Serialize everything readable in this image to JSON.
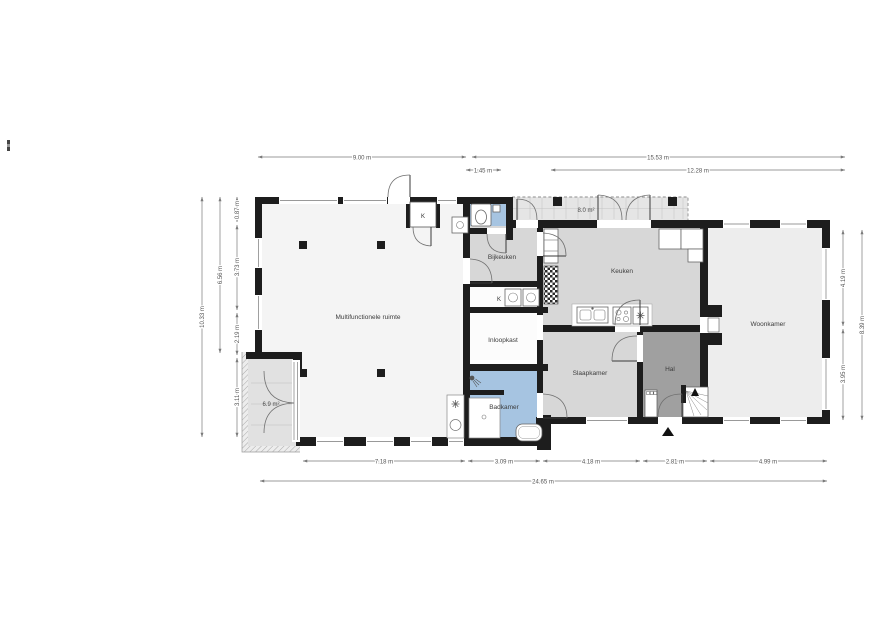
{
  "plan": {
    "rooms": {
      "multifunctionele_ruimte": "Multifunctionele ruimte",
      "bijkeuken": "Bijkeuken",
      "keuken": "Keuken",
      "woonkamer": "Woonkamer",
      "inloopkast": "Inloopkast",
      "slaapkamer": "Slaapkamer",
      "hal": "Hal",
      "badkamer": "Badkamer"
    },
    "areas": {
      "terrace": "8.0 m²",
      "porch": "6.9 m²"
    },
    "closets": {
      "top": "K",
      "laundry": "K"
    },
    "dims": {
      "top_9": "9.00 m",
      "top_145": "1.45 m",
      "top_1553": "15.53 m",
      "top_1228": "12.28 m",
      "bottom_718": "7.18 m",
      "bottom_309": "3.09 m",
      "bottom_418": "4.18 m",
      "bottom_281": "2.81 m",
      "bottom_499": "4.99 m",
      "bottom_total": "24.65 m",
      "left_total": "10.33 m",
      "left_656": "6.56 m",
      "left_087": "0.87 m",
      "left_373": "3.73 m",
      "left_219": "2.19 m",
      "left_311": "3.11 m",
      "right_419": "4.19 m",
      "right_395": "3.95 m",
      "right_total": "8.39 m"
    },
    "icons": {
      "entrance_arrow": "▲",
      "stairs_up_arrow": "▲",
      "snowflake": "✳"
    },
    "colors": {
      "wall": "#1d1d1d",
      "bathroom_blue": "#a6c4e1",
      "hall_gray": "#a0a0a0",
      "kitchen_gray": "#d7d7d7",
      "living_gray": "#ededed",
      "main_room": "#f4f4f4",
      "terrace": "#e5e5e5",
      "porch": "#e1e1e1",
      "dimension_line": "#7a7a7a"
    }
  }
}
